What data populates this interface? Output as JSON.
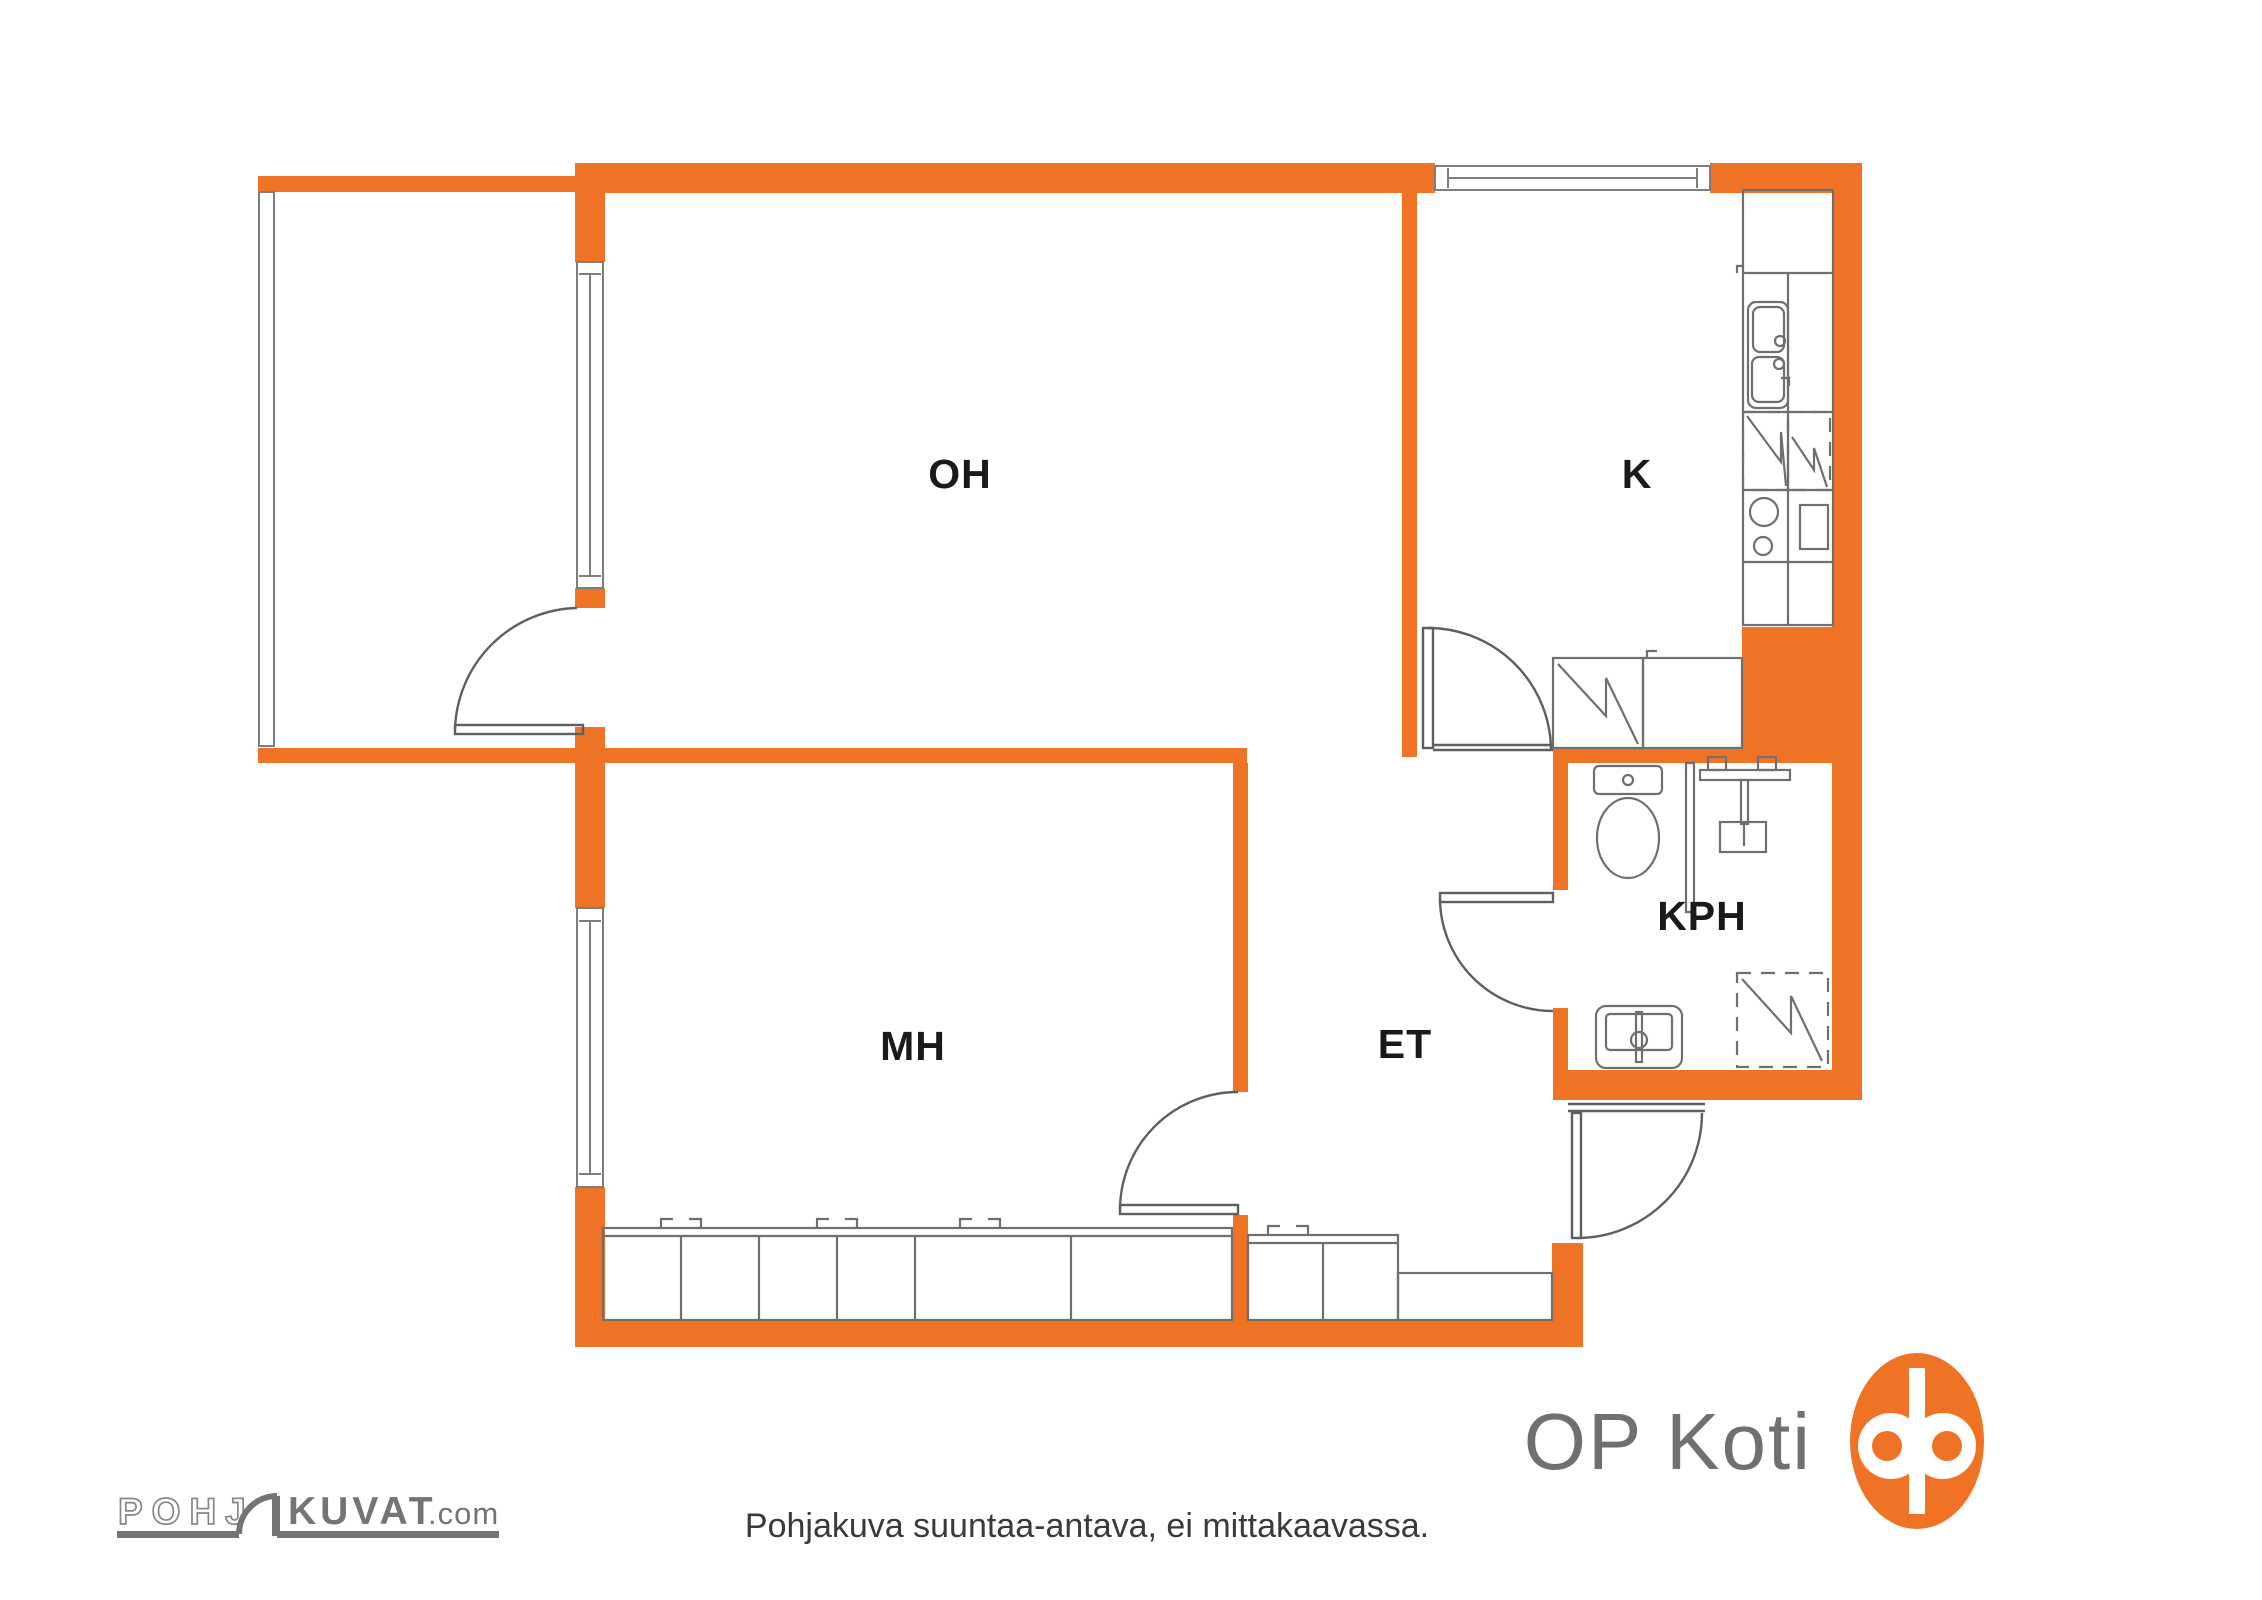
{
  "page": {
    "background": "#FFFFFF"
  },
  "plan": {
    "colors": {
      "wall_orange": "#EF7225",
      "line_gray": "#6F6F6F",
      "thin_line_gray": "#7E7E7E",
      "label_text": "#1A1A1A"
    },
    "rooms": [
      {
        "id": "oh",
        "label": "OH"
      },
      {
        "id": "k",
        "label": "K"
      },
      {
        "id": "mh",
        "label": "MH"
      },
      {
        "id": "et",
        "label": "ET"
      },
      {
        "id": "kph",
        "label": "KPH"
      }
    ],
    "fixtures": [
      "balcony-railing",
      "window",
      "door-arc",
      "wardrobe-row",
      "kitchen-tall-cabinet",
      "kitchen-sink",
      "dishwasher-dashed",
      "stove-burners",
      "oven",
      "fridge-closet-zigzag",
      "toilet",
      "shower-partition",
      "shower-mixer",
      "bathroom-sink",
      "washing-machine-dashed"
    ]
  },
  "footer": {
    "pohjakuvat_logo": {
      "part1": "POHJ",
      "part2": "KUVAT",
      "suffix": ".com",
      "color": "#737476"
    },
    "disclaimer": "Pohjakuva suuntaa-antava, ei mittakaavassa.",
    "op_koti": {
      "text": "OP Koti",
      "text_color": "#6F7072",
      "logo_color": "#EF7225"
    }
  }
}
